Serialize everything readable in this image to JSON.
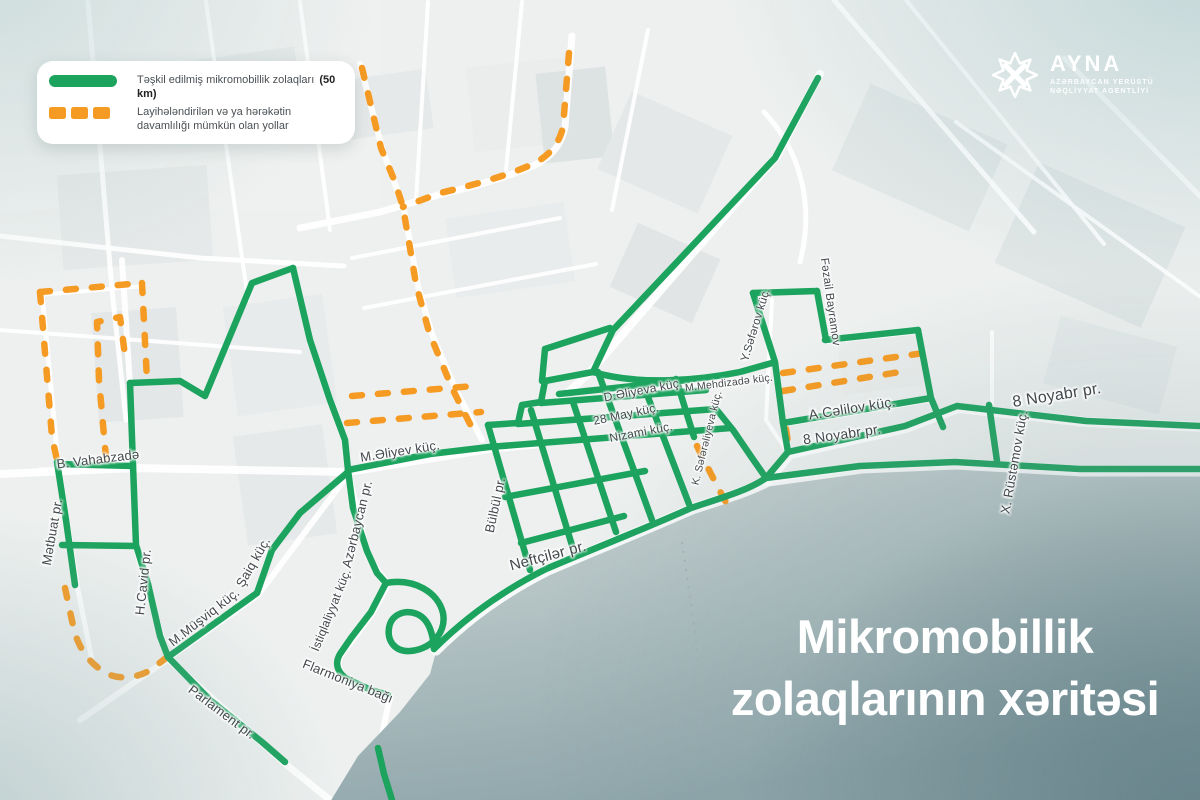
{
  "legend": {
    "item1": {
      "text": "Təşkil edilmiş mikromobillik zolaqları",
      "bold_suffix": "(50 km)"
    },
    "item2": {
      "text": "Layihələndirilən və ya hərəkətin davamlılığı mümkün olan yollar"
    }
  },
  "logo": {
    "title": "AYNA",
    "subtitle1": "AZƏRBAYCAN YERÜSTÜ",
    "subtitle2": "NƏQLİYYAT AGENTLİYİ"
  },
  "map_title": {
    "line1": "Mikromobillik",
    "line2": "zolaqlarının xəritəsi"
  },
  "colors": {
    "lane": "#1ca35e",
    "planned": "#f59b23",
    "label": "#43484c",
    "sea_deep": "#8aa2a7"
  },
  "street_labels": [
    {
      "id": "b-vahabzade",
      "text": "B. Vahabzadə",
      "x": 98,
      "y": 459,
      "rot": -7,
      "size": 13
    },
    {
      "id": "metbuat-pr",
      "text": "Mətbuat pr.",
      "x": 52,
      "y": 532,
      "rot": -80,
      "size": 13
    },
    {
      "id": "h-cavid-pr",
      "text": "H.Cavid pr.",
      "x": 143,
      "y": 582,
      "rot": -84,
      "size": 13
    },
    {
      "id": "m-musviq-kuc",
      "text": "M.Müşviq küç.",
      "x": 204,
      "y": 617,
      "rot": -38,
      "size": 13
    },
    {
      "id": "saiq-kuc",
      "text": "Şaiq küç.",
      "x": 253,
      "y": 562,
      "rot": -60,
      "size": 13
    },
    {
      "id": "parlament-pr",
      "text": "Parlament pr.",
      "x": 222,
      "y": 712,
      "rot": 37,
      "size": 13
    },
    {
      "id": "flarmoniya-bagi",
      "text": "Flarmoniya bağı",
      "x": 348,
      "y": 681,
      "rot": 22,
      "size": 13
    },
    {
      "id": "istiqlaliyyat-kuc",
      "text": "İstiqlaliyyat küç.",
      "x": 331,
      "y": 610,
      "rot": -68,
      "size": 12
    },
    {
      "id": "azerbaycan-pr",
      "text": "Azərbaycan pr.",
      "x": 357,
      "y": 524,
      "rot": -76,
      "size": 13
    },
    {
      "id": "m-eliyev-kuc",
      "text": "M.Əliyev küç.",
      "x": 400,
      "y": 451,
      "rot": -9,
      "size": 13
    },
    {
      "id": "bulbul-pr",
      "text": "Bülbül pr.",
      "x": 495,
      "y": 505,
      "rot": -78,
      "size": 13
    },
    {
      "id": "neftciler-pr",
      "text": "Neftçilər pr.",
      "x": 548,
      "y": 556,
      "rot": -15,
      "size": 15
    },
    {
      "id": "d-eliyeva-kuc",
      "text": "D.Əliyeva küç.",
      "x": 643,
      "y": 390,
      "rot": -11,
      "size": 12
    },
    {
      "id": "28-may-kuc",
      "text": "28 May küç.",
      "x": 626,
      "y": 414,
      "rot": -12,
      "size": 12
    },
    {
      "id": "nizami-kuc",
      "text": "Nizami küç.",
      "x": 641,
      "y": 432,
      "rot": -11,
      "size": 12
    },
    {
      "id": "m-mehdizade-kuc",
      "text": "M.Mehdizadə küç.",
      "x": 729,
      "y": 383,
      "rot": -7,
      "size": 10.5
    },
    {
      "id": "k-sefereliyeva-kuc",
      "text": "K. Səfərəliyeva küç.",
      "x": 707,
      "y": 438,
      "rot": -76,
      "size": 10.5
    },
    {
      "id": "y-seferov-kuc",
      "text": "Y.Səfərov küç.",
      "x": 756,
      "y": 325,
      "rot": -73,
      "size": 11.5
    },
    {
      "id": "fezail-bayramov",
      "text": "Fəzail Bayramov",
      "x": 830,
      "y": 302,
      "rot": 82,
      "size": 11.5
    },
    {
      "id": "a-celilov-kuc",
      "text": "A.Cəlilov küç.",
      "x": 852,
      "y": 408,
      "rot": -9,
      "size": 14
    },
    {
      "id": "8-noyabr-pr-west",
      "text": "8 Noyabr pr.",
      "x": 842,
      "y": 434,
      "rot": -8,
      "size": 14
    },
    {
      "id": "8-noyabr-pr-east",
      "text": "8 Noyabr pr.",
      "x": 1057,
      "y": 396,
      "rot": -9,
      "size": 16
    },
    {
      "id": "x-rustemov-kuc",
      "text": "X. Rüstəmov küç.",
      "x": 1014,
      "y": 462,
      "rot": -80,
      "size": 13
    }
  ]
}
